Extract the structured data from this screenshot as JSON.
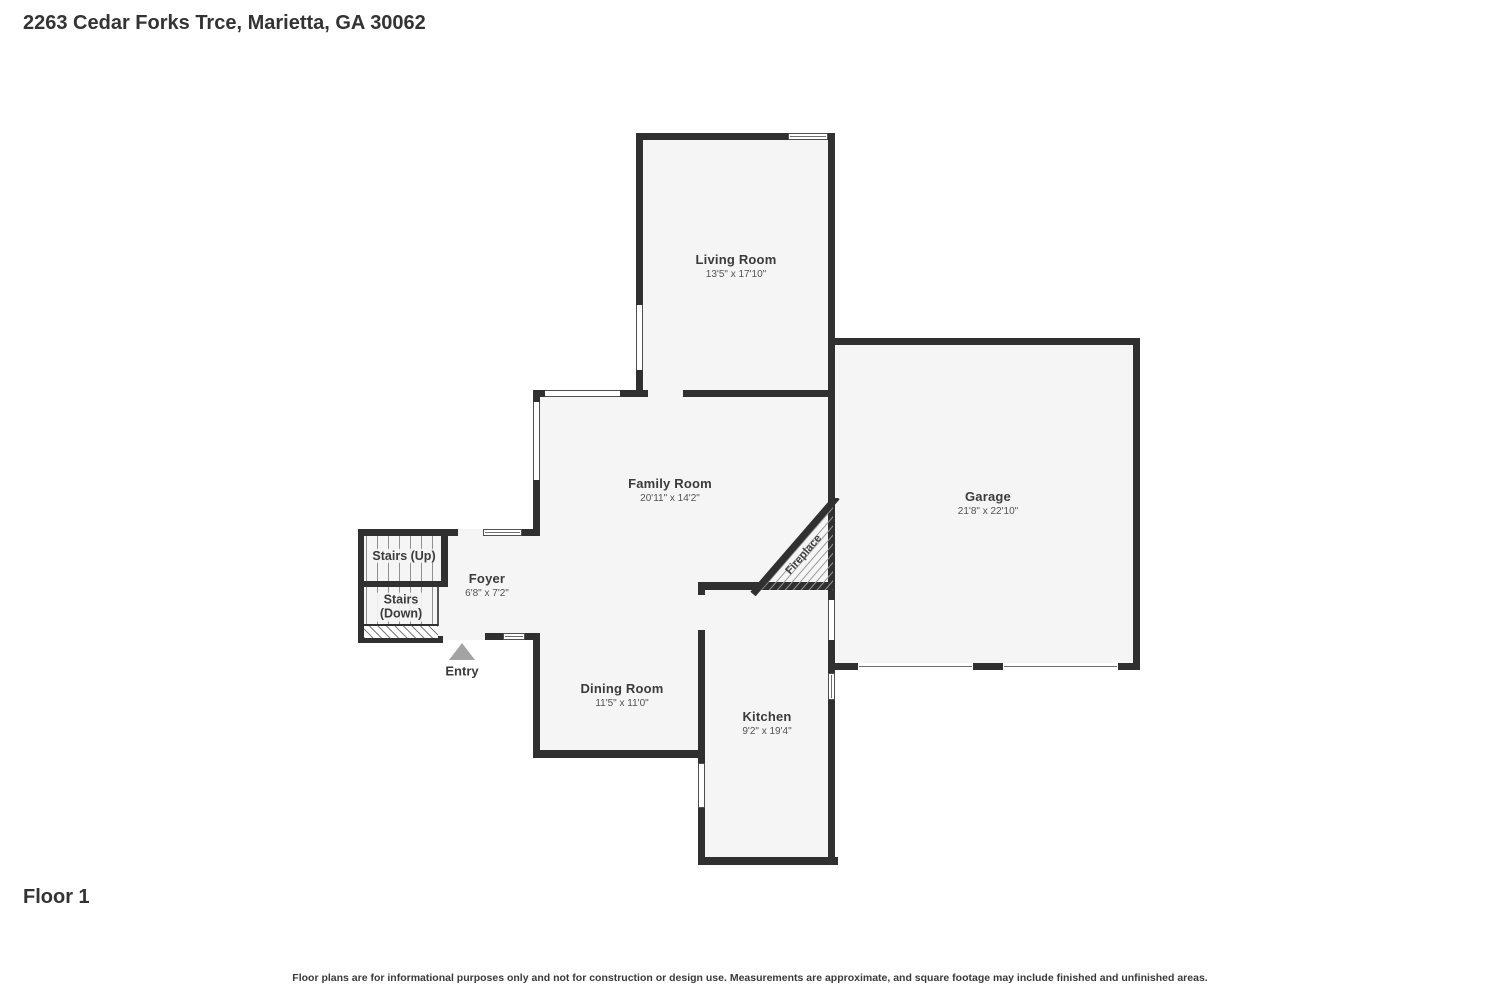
{
  "title": "2263 Cedar Forks Trce, Marietta, GA 30062",
  "floor_label": "Floor 1",
  "disclaimer": "Floor plans are for informational purposes only and not for construction or design use. Measurements are approximate, and square footage may include finished and unfinished areas.",
  "rooms": {
    "living_room": {
      "name": "Living Room",
      "dims": "13'5\" x 17'10\""
    },
    "family_room": {
      "name": "Family Room",
      "dims": "20'11\" x 14'2\""
    },
    "garage": {
      "name": "Garage",
      "dims": "21'8\" x 22'10\""
    },
    "foyer": {
      "name": "Foyer",
      "dims": "6'8\" x 7'2\""
    },
    "dining_room": {
      "name": "Dining Room",
      "dims": "11'5\" x 11'0\""
    },
    "kitchen": {
      "name": "Kitchen",
      "dims": "9'2\" x 19'4\""
    },
    "stairs_up": {
      "name": "Stairs (Up)"
    },
    "stairs_down": {
      "line1": "Stairs",
      "line2": "(Down)"
    },
    "fireplace": {
      "name": "Fireplace"
    },
    "entry": {
      "name": "Entry"
    }
  },
  "colors": {
    "wall": "#303030",
    "floor": "#f5f5f5",
    "text": "#3b3b3b",
    "dim_text": "#525252",
    "entry_arrow": "#a3a3a3",
    "window_border": "#4f4f4f"
  }
}
